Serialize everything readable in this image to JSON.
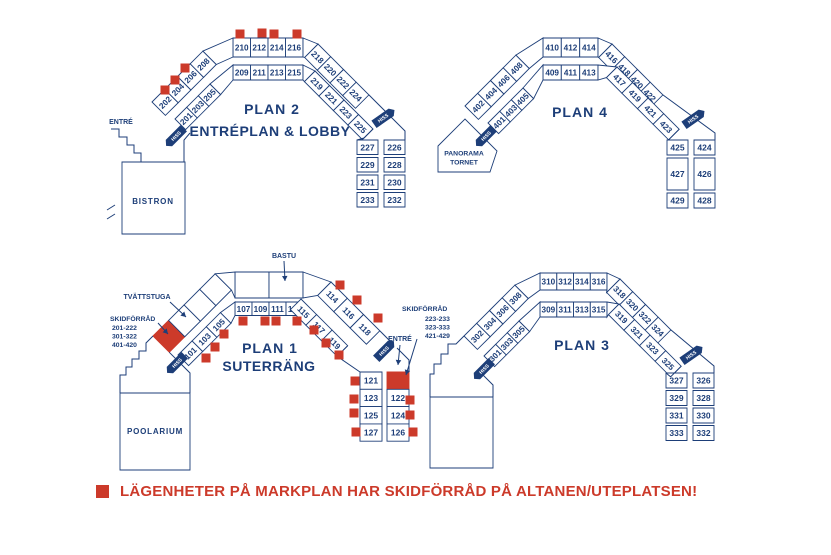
{
  "colors": {
    "navy": "#1d3e78",
    "red": "#cc3a2a",
    "white": "#ffffff"
  },
  "legend": {
    "text": "LÄGENHETER PÅ MARKPLAN HAR SKIDFÖRRÅD PÅ ALTANEN/UTEPLATSEN!"
  },
  "lift_label": "HISS",
  "plans": {
    "plan2": {
      "title": "PLAN 2",
      "subtitle": "ENTRÉPLAN & LOBBY",
      "entrance_label": "ENTRÉ",
      "facility_label": "BISTRON",
      "outer_left": [
        "202",
        "204",
        "206",
        "208"
      ],
      "outer_top": [
        "210",
        "212",
        "214",
        "216"
      ],
      "outer_right": [
        "218",
        "220",
        "222",
        "224"
      ],
      "inner_left": [
        "201",
        "203",
        "205"
      ],
      "inner_top": [
        "209",
        "211",
        "213",
        "215"
      ],
      "inner_right": [
        "219",
        "221",
        "223",
        "225"
      ],
      "col_left": [
        "227",
        "229",
        "231",
        "233"
      ],
      "col_right": [
        "226",
        "228",
        "230",
        "232"
      ]
    },
    "plan4": {
      "title": "PLAN 4",
      "facility_label": "PANORAMA TORNET",
      "outer_left": [
        "402",
        "404",
        "406",
        "408"
      ],
      "outer_top": [
        "410",
        "412",
        "414"
      ],
      "outer_right": [
        "416",
        "418",
        "420",
        "422"
      ],
      "inner_left": [
        "401",
        "403",
        "405"
      ],
      "inner_top": [
        "409",
        "411",
        "413"
      ],
      "inner_right": [
        "417",
        "419",
        "421",
        "423"
      ],
      "col_left": [
        "425",
        "427",
        "429"
      ],
      "col_right": [
        "424",
        "426",
        "428"
      ]
    },
    "plan1": {
      "title": "PLAN 1",
      "subtitle": "SUTERRÄNG",
      "entrance_label": "ENTRÉ",
      "facility_label": "POOLARIUM",
      "bastu_label": "BASTU",
      "tvattstuga_label": "TVÄTTSTUGA",
      "skidforrad_left": {
        "title": "SKIDFÖRRÅD",
        "ranges": [
          "201-222",
          "301-322",
          "401-420"
        ]
      },
      "skidforrad_right": {
        "title": "SKIDFÖRRÅD",
        "ranges": [
          "223-233",
          "323-333",
          "421-429"
        ]
      },
      "inner_left": [
        "101",
        "103",
        "105"
      ],
      "inner_top": [
        "107",
        "109",
        "111",
        "113"
      ],
      "inner_right": [
        "115",
        "117",
        "119"
      ],
      "outer_right": [
        "114",
        "116",
        "118"
      ],
      "col_left": [
        "121",
        "123",
        "125",
        "127"
      ],
      "col_right": [
        "122",
        "124",
        "126"
      ]
    },
    "plan3": {
      "title": "PLAN 3",
      "outer_left": [
        "302",
        "304",
        "306",
        "308"
      ],
      "outer_top": [
        "310",
        "312",
        "314",
        "316"
      ],
      "outer_right": [
        "318",
        "320",
        "322",
        "324"
      ],
      "inner_left": [
        "301",
        "303",
        "305"
      ],
      "inner_top": [
        "309",
        "311",
        "313",
        "315"
      ],
      "inner_right": [
        "319",
        "321",
        "323",
        "325"
      ],
      "col_left": [
        "327",
        "329",
        "331",
        "333"
      ],
      "col_right": [
        "326",
        "328",
        "330",
        "332"
      ]
    }
  }
}
